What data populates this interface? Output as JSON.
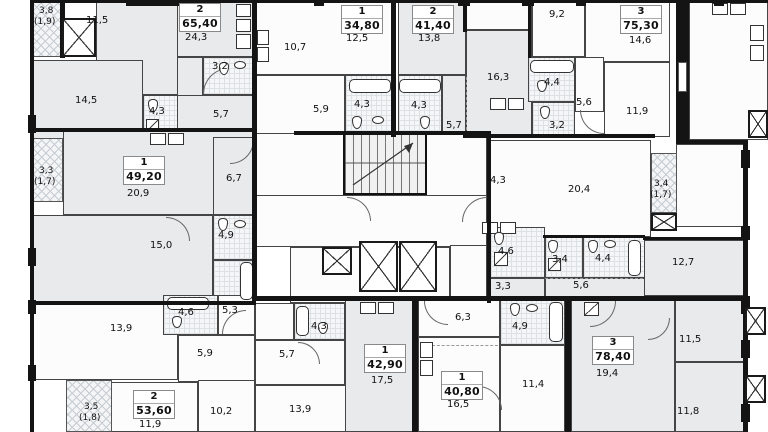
{
  "plan_type": "residential-floor-plan",
  "colors": {
    "wall": "#141414",
    "room_fill_gray": "#e8eaec",
    "room_fill_white": "#fcfcfd",
    "bath_tile": "#f5f6f7",
    "balcony_hatch": "#f3f5f6",
    "text": "#111111",
    "card_bg": "#ffffff"
  },
  "apartments": [
    {
      "rooms_count": "2",
      "total_area": "65,40",
      "room_areas": [
        "11,5",
        "24,3",
        "3,2",
        "14,5",
        "4,3",
        "5,7"
      ],
      "balcony": {
        "area": "3,8",
        "counted": "(1,9)"
      }
    },
    {
      "rooms_count": "1",
      "total_area": "34,80",
      "room_areas": [
        "10,7",
        "12,5",
        "5,9",
        "4,3"
      ]
    },
    {
      "rooms_count": "2",
      "total_area": "41,40",
      "room_areas": [
        "13,8",
        "4,3",
        "5,7",
        "16,3"
      ]
    },
    {
      "rooms_count": "3",
      "total_area": "75,30",
      "room_areas": [
        "9,2",
        "14,6",
        "4,4",
        "5,6",
        "3,2",
        "11,9",
        "4,3",
        "20,4"
      ],
      "balcony": {
        "area": "3,4",
        "counted": "(1,7)"
      }
    },
    {
      "rooms_count": "1",
      "total_area": "49,20",
      "room_areas": [
        "20,9",
        "6,7",
        "15,0",
        "4,9"
      ],
      "balcony": {
        "area": "3,3",
        "counted": "(1,7)"
      }
    },
    {
      "rooms_count": "2",
      "total_area": "53,60",
      "room_areas": [
        "13,9",
        "4,6",
        "5,3",
        "5,9",
        "11,9",
        "10,2"
      ],
      "balcony": {
        "area": "3,5",
        "counted": "(1,8)"
      }
    },
    {
      "rooms_count": "1",
      "total_area": "42,90",
      "room_areas": [
        "4,3",
        "5,7",
        "17,5",
        "13,9"
      ]
    },
    {
      "rooms_count": "1",
      "total_area": "40,80",
      "room_areas": [
        "6,3",
        "4,9",
        "16,5",
        "11,4"
      ]
    },
    {
      "rooms_count": "3",
      "total_area": "78,40",
      "room_areas": [
        "4,6",
        "3,4",
        "4,4",
        "3,3",
        "5,6",
        "12,7",
        "19,4",
        "11,5",
        "11,8"
      ]
    }
  ]
}
